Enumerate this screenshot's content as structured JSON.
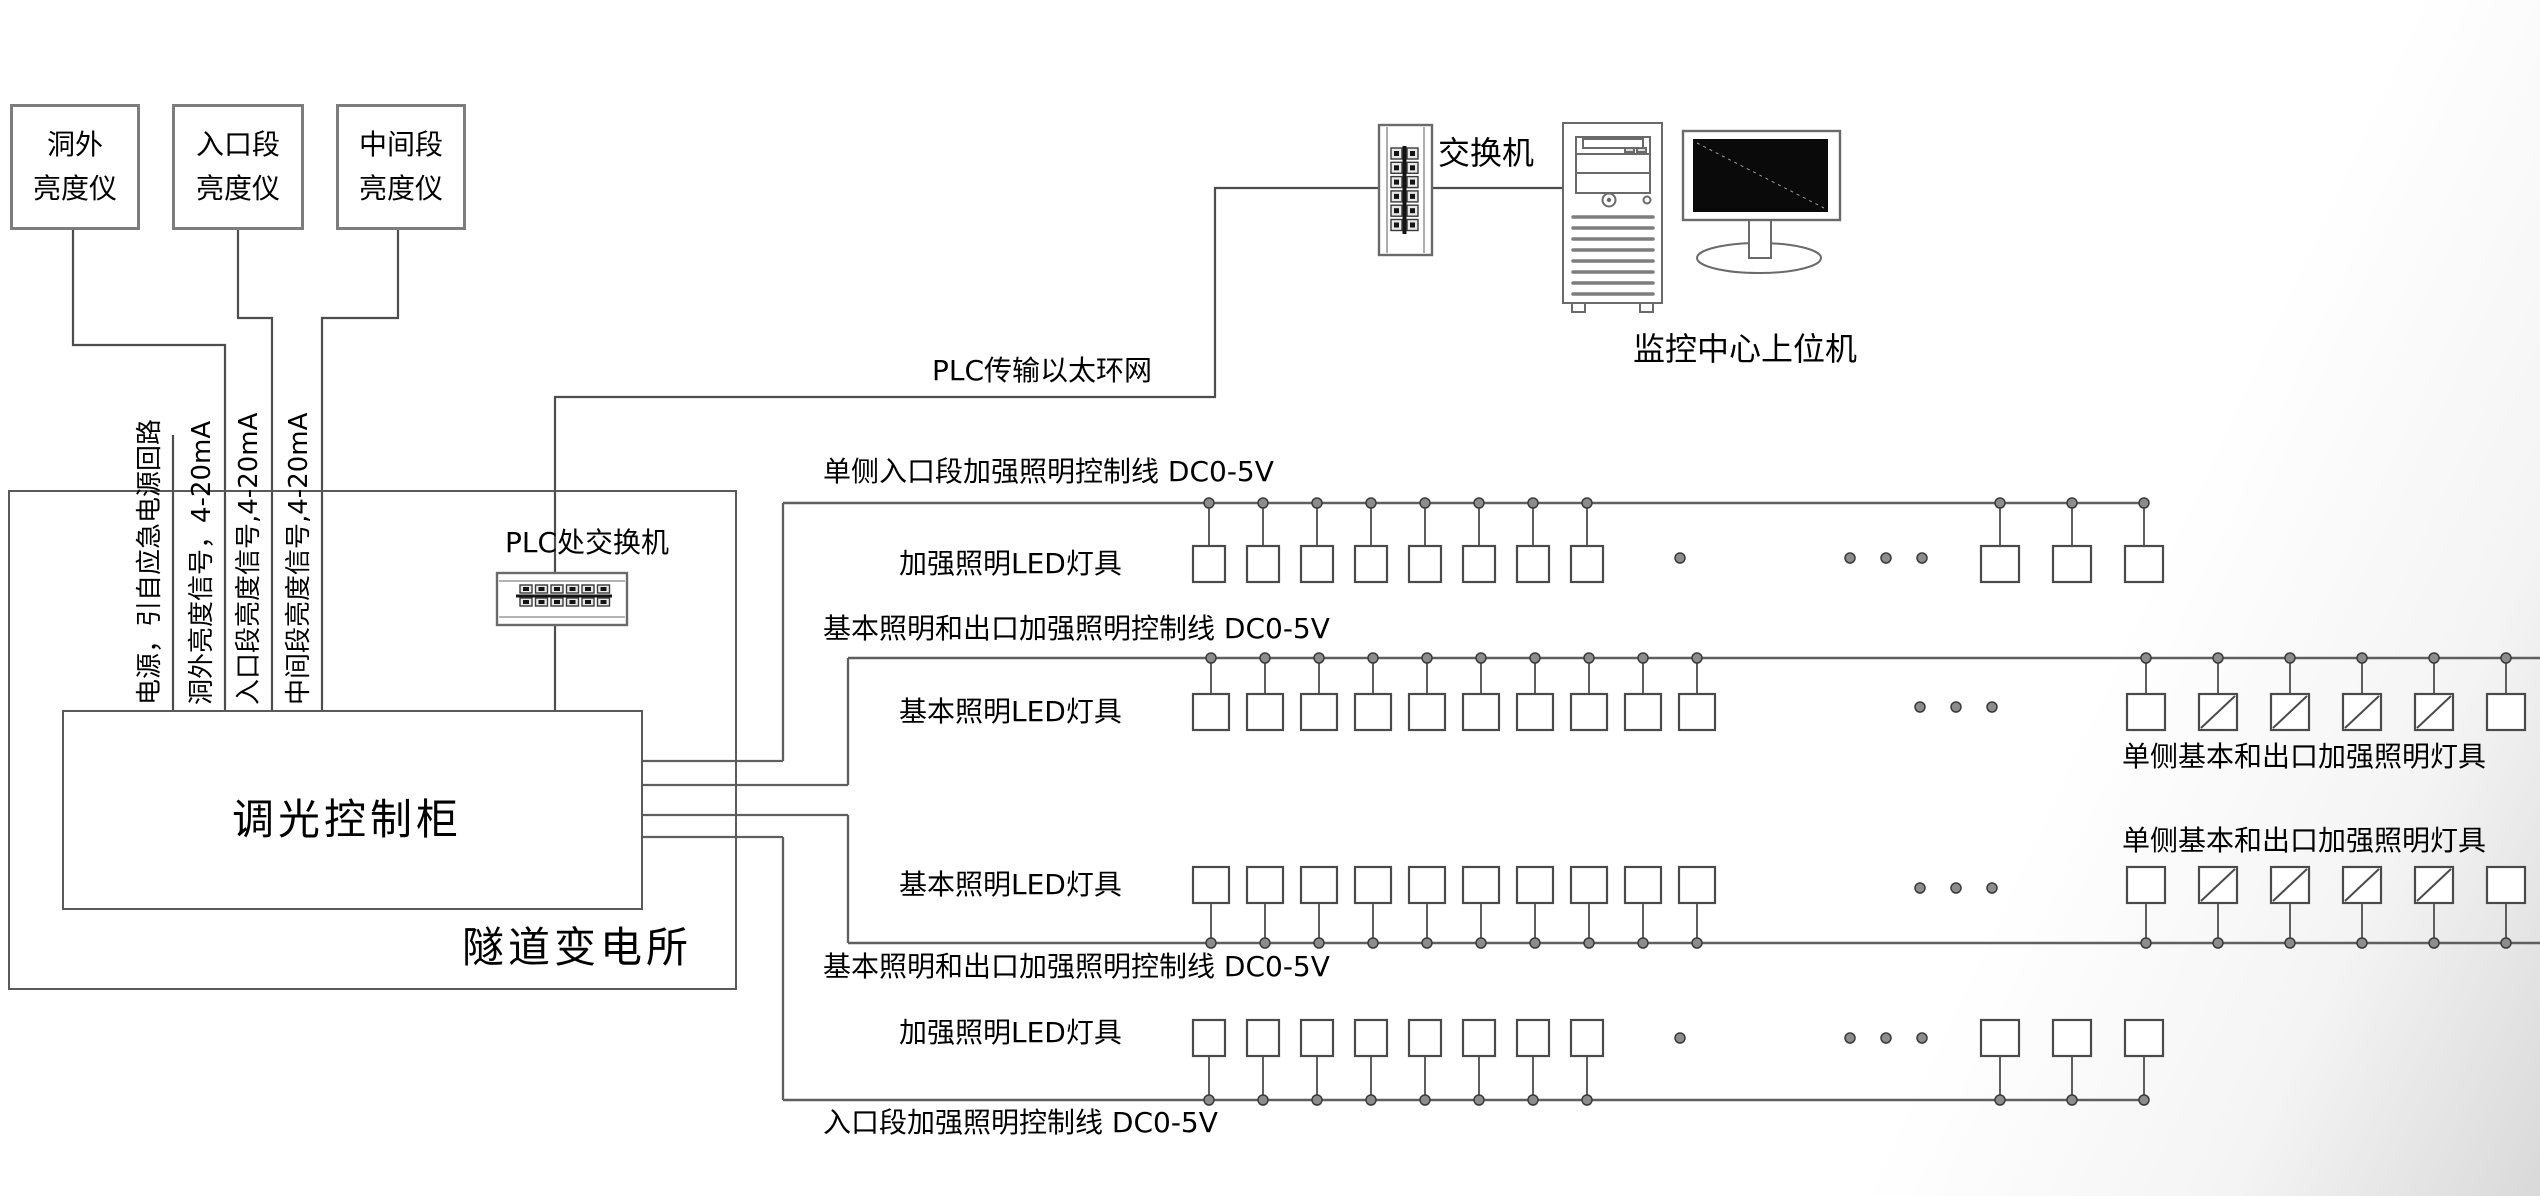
{
  "colors": {
    "line": "#5f5f5f",
    "route": "#4d4d4d",
    "box": "#4a4a4a",
    "dot_fill": "#8c8c8c",
    "dot_stroke": "#3a3a3a",
    "screen": "#0a0a0a"
  },
  "meters": [
    {
      "line1": "洞外",
      "line2": "亮度仪"
    },
    {
      "line1": "入口段",
      "line2": "亮度仪"
    },
    {
      "line1": "中间段",
      "line2": "亮度仪"
    }
  ],
  "signals": [
    "电源，引自应急电源回路",
    "洞外亮度信号，4-20mA",
    "入口段亮度信号,4-20mA",
    "中间段亮度信号,4-20mA"
  ],
  "cabinet": {
    "label": "调光控制柜"
  },
  "substation": {
    "label": "隧道变电所"
  },
  "plc_switch": {
    "label": "PLC处交换机"
  },
  "ethernet": {
    "label": "PLC传输以太环网"
  },
  "top_switch": {
    "label": "交换机"
  },
  "host": {
    "label": "监控中心上位机"
  },
  "diagram": {
    "cabinet_exit_x": 643,
    "rows": [
      {
        "control_label": "单侧入口段加强照明控制线 DC0-5V",
        "lamp_label": "加强照明LED灯具",
        "line_y": 503,
        "line_x1": 783,
        "line_x2": 2147,
        "cab_y": 761,
        "riser_x": 783,
        "lamps_side": "below",
        "lamp_top": 546,
        "lamp_h": 36,
        "groups": [
          {
            "start": 1193,
            "count": 8,
            "spacing": 54,
            "w": 32,
            "slashed": []
          },
          {
            "start": 1981,
            "count": 3,
            "spacing": 72,
            "w": 38,
            "slashed": []
          }
        ],
        "ellipsis_x": [
          1680,
          1850,
          1886,
          1922
        ],
        "ellipsis_y": 558
      },
      {
        "control_label": "基本照明和出口加强照明控制线 DC0-5V",
        "lamp_label": "基本照明LED灯具",
        "right_label": "单侧基本和出口加强照明灯具",
        "line_y": 658,
        "line_x1": 848,
        "line_x2": 2540,
        "cab_y": 785,
        "riser_x": 848,
        "lamps_side": "below",
        "lamp_top": 694,
        "lamp_h": 36,
        "groups": [
          {
            "start": 1193,
            "count": 10,
            "spacing": 54,
            "w": 36,
            "slashed": []
          },
          {
            "start": 2127,
            "count": 6,
            "spacing": 72,
            "w": 38,
            "slashed": [
              1,
              2,
              3,
              4
            ]
          }
        ],
        "ellipsis_x": [
          1920,
          1956,
          1992
        ],
        "ellipsis_y": 707
      },
      {
        "control_label": "基本照明和出口加强照明控制线 DC0-5V",
        "lamp_label": "基本照明LED灯具",
        "right_label": "单侧基本和出口加强照明灯具",
        "line_y": 943,
        "line_x1": 848,
        "line_x2": 2540,
        "cab_y": 815,
        "riser_x": 848,
        "lamps_side": "above",
        "lamp_top": 867,
        "lamp_h": 36,
        "groups": [
          {
            "start": 1193,
            "count": 10,
            "spacing": 54,
            "w": 36,
            "slashed": []
          },
          {
            "start": 2127,
            "count": 6,
            "spacing": 72,
            "w": 38,
            "slashed": [
              1,
              2,
              3,
              4
            ]
          }
        ],
        "ellipsis_x": [
          1920,
          1956,
          1992
        ],
        "ellipsis_y": 888
      },
      {
        "control_label": "入口段加强照明控制线 DC0-5V",
        "lamp_label": "加强照明LED灯具",
        "line_y": 1100,
        "line_x1": 783,
        "line_x2": 2147,
        "cab_y": 837,
        "riser_x": 783,
        "lamps_side": "above",
        "lamp_top": 1020,
        "lamp_h": 36,
        "groups": [
          {
            "start": 1193,
            "count": 8,
            "spacing": 54,
            "w": 32,
            "slashed": []
          },
          {
            "start": 1981,
            "count": 3,
            "spacing": 72,
            "w": 38,
            "slashed": []
          }
        ],
        "ellipsis_x": [
          1680,
          1850,
          1886,
          1922
        ],
        "ellipsis_y": 1038
      }
    ]
  }
}
